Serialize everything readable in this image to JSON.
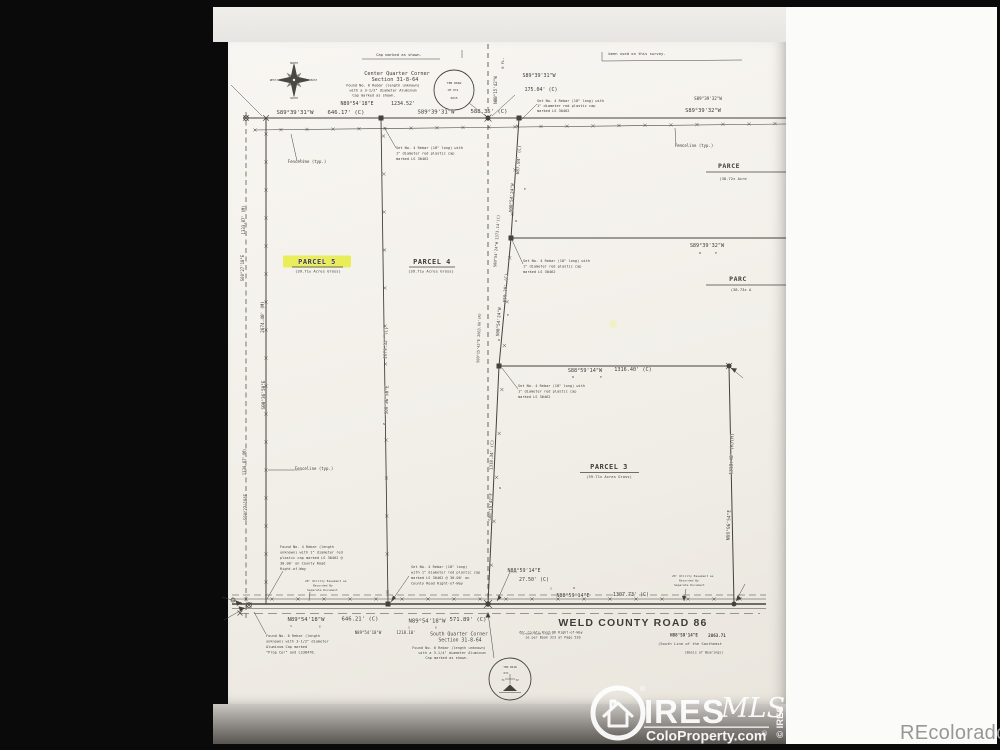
{
  "watermarks": {
    "recolorado": "REcolorado",
    "ires": {
      "name": "IRES",
      "mls": "MLS",
      "site": "ColoProperty.com",
      "reg": "®",
      "copyright": "© IRES"
    }
  },
  "plat": {
    "parcels": [
      {
        "name": "PARCEL 5",
        "area": "(39.71± Acres Gross)",
        "highlighted": true
      },
      {
        "name": "PARCEL 4",
        "area": "(39.71± Acres Gross)",
        "highlighted": false
      },
      {
        "name": "PARCEL 3",
        "area": "(39.71± Acres Gross)",
        "highlighted": false
      },
      {
        "name": "PARCE",
        "area": "(38.72± Acre",
        "highlighted": false
      },
      {
        "name": "PARC",
        "area": "(38.73± A",
        "highlighted": false
      }
    ],
    "road": {
      "name": "WELD COUNTY ROAD 86",
      "row_note": "60' County Road 86 Right-of-Way as per Book 323 at Page 520",
      "south_line": "(South Line of the Southeast",
      "basis": "(Basis of Bearings)"
    },
    "labels": [
      {
        "t": "Cap marked as shown.",
        "x": 399,
        "y": 56,
        "s": 3.8
      },
      {
        "t": "been used on this survey.",
        "x": 637,
        "y": 55,
        "s": 3.8
      },
      {
        "t": "Center Quarter Corner",
        "x": 397,
        "y": 75,
        "s": 5.2
      },
      {
        "t": "Section 31-8-64",
        "x": 395,
        "y": 81,
        "s": 5.2
      },
      {
        "t": "Found No. 6 Rebar (length unknown)",
        "x": 383,
        "y": 86.5,
        "s": 3.6
      },
      {
        "t": "with a 3-1/2\" diameter Aluminum",
        "x": 383,
        "y": 91.5,
        "s": 3.6
      },
      {
        "t": "Cap marked as shown.",
        "x": 374,
        "y": 96.5,
        "s": 3.6
      },
      {
        "t": "N89°54'18\"E",
        "x": 357,
        "y": 105,
        "s": 5
      },
      {
        "t": "1234.52'",
        "x": 403,
        "y": 105,
        "s": 5
      },
      {
        "t": "T8N R64W",
        "x": 454,
        "y": 84,
        "s": 3
      },
      {
        "t": "CM 931",
        "x": 453,
        "y": 91,
        "s": 3
      },
      {
        "t": "2015",
        "x": 454,
        "y": 99,
        "s": 3
      },
      {
        "t": "S89°39'31\"W",
        "x": 295,
        "y": 114,
        "s": 5.6
      },
      {
        "t": "646.17' (C)",
        "x": 346,
        "y": 114,
        "s": 5.6
      },
      {
        "t": "S89°39'31\"W",
        "x": 436,
        "y": 113.5,
        "s": 5.6
      },
      {
        "t": "588.35' (C)",
        "x": 489,
        "y": 113,
        "s": 5.6
      },
      {
        "t": "S89°39'31\"W",
        "x": 539,
        "y": 77,
        "s": 5
      },
      {
        "t": "175.04' (C)",
        "x": 541,
        "y": 91,
        "s": 5
      },
      {
        "t": "S89°39'32\"W",
        "x": 708,
        "y": 100,
        "s": 4.2
      },
      {
        "t": "S89°39'32\"W",
        "x": 703,
        "y": 112,
        "s": 5.4
      },
      {
        "t": "6 FL.",
        "x": 504,
        "y": 63,
        "s": 3.8,
        "r": -90
      },
      {
        "t": "N00°15'42\"W",
        "x": 497,
        "y": 90,
        "s": 4.2,
        "r": -90
      },
      {
        "t": "Set No. 4 Rebar (18\" long) with",
        "x": 396,
        "y": 149,
        "s": 3.6,
        "a": "s"
      },
      {
        "t": "1\" diameter red plastic cap",
        "x": 396,
        "y": 154.5,
        "s": 3.6,
        "a": "s"
      },
      {
        "t": "marked LS 30462",
        "x": 396,
        "y": 160,
        "s": 3.6,
        "a": "s"
      },
      {
        "t": "Set No. 4 Rebar (18\" long) with",
        "x": 537,
        "y": 102,
        "s": 3.6,
        "a": "s"
      },
      {
        "t": "1\" diameter red plastic cap",
        "x": 537,
        "y": 107,
        "s": 3.6,
        "a": "s"
      },
      {
        "t": "marked LS 30462",
        "x": 537,
        "y": 112,
        "s": 3.6,
        "a": "s"
      },
      {
        "t": "Set No. 4 Rebar (18\" long) with",
        "x": 523,
        "y": 262,
        "s": 3.6,
        "a": "s"
      },
      {
        "t": "1\" diameter red plastic cap",
        "x": 523,
        "y": 267.5,
        "s": 3.6,
        "a": "s"
      },
      {
        "t": "marked LS 30462",
        "x": 523,
        "y": 273,
        "s": 3.6,
        "a": "s"
      },
      {
        "t": "Set No. 4 Rebar (18\" long) with",
        "x": 518,
        "y": 387,
        "s": 3.6,
        "a": "s"
      },
      {
        "t": "1\" diameter red plastic cap",
        "x": 518,
        "y": 392.5,
        "s": 3.6,
        "a": "s"
      },
      {
        "t": "marked LS 30462",
        "x": 518,
        "y": 398,
        "s": 3.6,
        "a": "s"
      },
      {
        "t": "Fenceline (typ.)",
        "x": 307,
        "y": 163,
        "s": 4
      },
      {
        "t": "Fenceline (typ.)",
        "x": 694,
        "y": 147,
        "s": 4
      },
      {
        "t": "Fenceline (typ.)",
        "x": 314,
        "y": 470,
        "s": 4
      },
      {
        "t": "687.84' (C)",
        "x": 520,
        "y": 160,
        "s": 4.4,
        "r": -86
      },
      {
        "t": "S00°54'24\"W",
        "x": 513,
        "y": 198,
        "s": 4.4,
        "r": -86
      },
      {
        "t": "E",
        "x": 525,
        "y": 190,
        "s": 3
      },
      {
        "t": "N",
        "x": 516,
        "y": 222,
        "s": 3
      },
      {
        "t": "S00°54'24\"W 1373.14'(C)",
        "x": 498,
        "y": 241,
        "s": 3.8,
        "r": -86
      },
      {
        "t": "650.30' (C)",
        "x": 507,
        "y": 288,
        "s": 4.4,
        "r": -86
      },
      {
        "t": "S00°54'24\"W",
        "x": 500,
        "y": 322,
        "s": 4.4,
        "r": -86
      },
      {
        "t": "E",
        "x": 508,
        "y": 316,
        "s": 3
      },
      {
        "t": "N",
        "x": 499,
        "y": 341,
        "s": 3
      },
      {
        "t": "S00°15'42\"E 2663.66'(R)",
        "x": 480,
        "y": 338,
        "s": 3.6,
        "r": -88
      },
      {
        "t": "1333.87' (M)",
        "x": 245,
        "y": 220,
        "s": 4,
        "r": -90
      },
      {
        "t": "S00°27'18\"E",
        "x": 244,
        "y": 268,
        "s": 4,
        "r": -90
      },
      {
        "t": "2674.40' (M)",
        "x": 264,
        "y": 317,
        "s": 4.4,
        "r": -90
      },
      {
        "t": "S00°36'50\"E",
        "x": 265,
        "y": 395,
        "s": 4.4,
        "r": -90
      },
      {
        "t": "1330.87'(M)",
        "x": 246,
        "y": 462,
        "s": 4,
        "r": -90
      },
      {
        "t": "S00°27'18\"E",
        "x": 247,
        "y": 507,
        "s": 4,
        "r": -90
      },
      {
        "t": "2679.32' (C)",
        "x": 387,
        "y": 343,
        "s": 4.4,
        "r": -88
      },
      {
        "t": "S00°36'50\"E",
        "x": 388,
        "y": 400,
        "s": 4.4,
        "r": -88
      },
      {
        "t": "N",
        "x": 384,
        "y": 425,
        "s": 3
      },
      {
        "t": "PARCEL 5",
        "x": 317,
        "y": 264,
        "s": 7,
        "b": 1,
        "ls": 0.5
      },
      {
        "t": "(39.71± Acres Gross)",
        "x": 318,
        "y": 272.5,
        "s": 3.8
      },
      {
        "t": "PARCEL 4",
        "x": 432,
        "y": 264,
        "s": 7,
        "b": 1,
        "ls": 0.5
      },
      {
        "t": "(39.71± Acres Gross)",
        "x": 431,
        "y": 272.5,
        "s": 3.8
      },
      {
        "t": "PARCEL 3",
        "x": 609,
        "y": 469,
        "s": 7,
        "b": 1,
        "ls": 0.5
      },
      {
        "t": "(39.71± Acres Gross)",
        "x": 609,
        "y": 478,
        "s": 3.8
      },
      {
        "t": "PARCE",
        "x": 729,
        "y": 168,
        "s": 6.5,
        "b": 1,
        "ls": 0.5
      },
      {
        "t": "(38.72± Acre",
        "x": 733,
        "y": 180,
        "s": 3.8
      },
      {
        "t": "PARC",
        "x": 738,
        "y": 281,
        "s": 6.5,
        "b": 1,
        "ls": 0.5
      },
      {
        "t": "(38.73± A",
        "x": 741,
        "y": 291,
        "s": 3.8
      },
      {
        "t": "S89°39'32\"W",
        "x": 707,
        "y": 247,
        "s": 5.2
      },
      {
        "t": "N",
        "x": 700,
        "y": 254,
        "s": 3
      },
      {
        "t": "E",
        "x": 716,
        "y": 254,
        "s": 3
      },
      {
        "t": "S88°59'14\"W",
        "x": 585,
        "y": 372,
        "s": 5.2
      },
      {
        "t": "1316.40' (C)",
        "x": 633,
        "y": 371,
        "s": 5.2
      },
      {
        "t": "N",
        "x": 573,
        "y": 378,
        "s": 3
      },
      {
        "t": "E",
        "x": 601,
        "y": 378,
        "s": 3
      },
      {
        "t": "1318.48' (R)(M)",
        "x": 733,
        "y": 454,
        "s": 4.6,
        "r": -88
      },
      {
        "t": "N00°06'54\"E",
        "x": 730,
        "y": 525,
        "s": 4.6,
        "r": -88
      },
      {
        "t": "1318.34' (C)",
        "x": 493,
        "y": 455,
        "s": 4.2,
        "r": -88
      },
      {
        "t": "N",
        "x": 500,
        "y": 489,
        "s": 3
      },
      {
        "t": "S00°15'42\"E",
        "x": 492,
        "y": 507,
        "s": 4.2,
        "r": -88
      },
      {
        "t": "Found No. 4 Rebar (length",
        "x": 280,
        "y": 548,
        "s": 3.6,
        "a": "s"
      },
      {
        "t": "unknown) with 1\" diameter red",
        "x": 280,
        "y": 553.5,
        "s": 3.6,
        "a": "s"
      },
      {
        "t": "plastic cap marked LS 30462 @",
        "x": 280,
        "y": 559,
        "s": 3.6,
        "a": "s"
      },
      {
        "t": "30.00' on County Road",
        "x": 280,
        "y": 564.5,
        "s": 3.6,
        "a": "s"
      },
      {
        "t": "Right-of-Way",
        "x": 280,
        "y": 570,
        "s": 3.6,
        "a": "s"
      },
      {
        "t": "20' Utility Easement as",
        "x": 305,
        "y": 582,
        "s": 3,
        "a": "s"
      },
      {
        "t": "Recorded By",
        "x": 313,
        "y": 586.5,
        "s": 3,
        "a": "s"
      },
      {
        "t": "Separate Document",
        "x": 307,
        "y": 591,
        "s": 3,
        "a": "s"
      },
      {
        "t": "Set No. 4 Rebar (18\" long)",
        "x": 411,
        "y": 568,
        "s": 3.6,
        "a": "s"
      },
      {
        "t": "with 1\" diameter red plastic cap",
        "x": 411,
        "y": 573.5,
        "s": 3.6,
        "a": "s"
      },
      {
        "t": "marked LS 30462 @ 30.00' on",
        "x": 411,
        "y": 579,
        "s": 3.6,
        "a": "s"
      },
      {
        "t": "County Road Right-of-Way",
        "x": 411,
        "y": 584.5,
        "s": 3.6,
        "a": "s"
      },
      {
        "t": "N88°59'14\"E",
        "x": 524,
        "y": 572,
        "s": 5
      },
      {
        "t": "27.50' (C)",
        "x": 534,
        "y": 581,
        "s": 5
      },
      {
        "t": "20' Utility Easement as",
        "x": 672,
        "y": 577,
        "s": 3,
        "a": "s"
      },
      {
        "t": "Recorded By",
        "x": 679,
        "y": 581.5,
        "s": 3,
        "a": "s"
      },
      {
        "t": "Separate Document",
        "x": 674,
        "y": 586,
        "s": 3,
        "a": "s"
      },
      {
        "t": "S",
        "x": 551,
        "y": 589.5,
        "s": 3
      },
      {
        "t": "W",
        "x": 574,
        "y": 589,
        "s": 3
      },
      {
        "t": "N88°59'14\"E",
        "x": 573,
        "y": 597,
        "s": 5
      },
      {
        "t": "1307.73' (C)",
        "x": 631,
        "y": 596,
        "s": 5
      },
      {
        "t": "N89°54'18\"W",
        "x": 306,
        "y": 621,
        "s": 5.6
      },
      {
        "t": "646.21' (C)",
        "x": 360,
        "y": 620.5,
        "s": 5.6
      },
      {
        "t": "S",
        "x": 291,
        "y": 627,
        "s": 3
      },
      {
        "t": "E",
        "x": 320,
        "y": 627.5,
        "s": 3
      },
      {
        "t": "N89°54'18\"W",
        "x": 427,
        "y": 622.5,
        "s": 5.6
      },
      {
        "t": "571.89' (C)",
        "x": 468,
        "y": 621,
        "s": 5.6
      },
      {
        "t": "S",
        "x": 409,
        "y": 628.5,
        "s": 3
      },
      {
        "t": "E",
        "x": 436,
        "y": 628.5,
        "s": 3
      },
      {
        "t": "N89°54'18\"W",
        "x": 368,
        "y": 634,
        "s": 4
      },
      {
        "t": "1218.10'",
        "x": 406,
        "y": 634,
        "s": 4
      },
      {
        "t": "WELD COUNTY ROAD 86",
        "x": 633,
        "y": 626,
        "s": 10.5,
        "b": 1,
        "f": "sans",
        "ls": 1.2
      },
      {
        "t": "60' County Road 86 Right-of-Way",
        "x": 551,
        "y": 633.5,
        "s": 3.4
      },
      {
        "t": "as per Book 323 at Page 520",
        "x": 553,
        "y": 638.5,
        "s": 3.4
      },
      {
        "t": "N88°59'14\"E",
        "x": 684,
        "y": 636.5,
        "s": 4.2,
        "b": 1
      },
      {
        "t": "2863.71",
        "x": 717,
        "y": 637,
        "s": 4.2,
        "b": 1
      },
      {
        "t": "(South Line of the Southeast",
        "x": 690,
        "y": 645,
        "s": 3.8
      },
      {
        "t": "(Basis of Bearings)",
        "x": 704,
        "y": 653.5,
        "s": 3.4
      },
      {
        "t": "(Gravel Road (Typ))",
        "x": 537,
        "y": 634.5,
        "s": 2.8
      },
      {
        "t": "South Quarter Corner",
        "x": 459,
        "y": 635.5,
        "s": 4.8
      },
      {
        "t": "Section 31-8-64",
        "x": 460,
        "y": 641.5,
        "s": 4.8
      },
      {
        "t": "Found No. 6 Rebar (length unknown)",
        "x": 449,
        "y": 649,
        "s": 3.6
      },
      {
        "t": "with a 3-1/4\" diameter Aluminum",
        "x": 452,
        "y": 654,
        "s": 3.6
      },
      {
        "t": "Cap marked as shown.",
        "x": 447,
        "y": 659,
        "s": 3.6
      },
      {
        "t": "Found No. 6 Rebar (length",
        "x": 266,
        "y": 637,
        "s": 3.6,
        "a": "s"
      },
      {
        "t": "unknown) with 3-1/2\" diameter",
        "x": 266,
        "y": 642.5,
        "s": 3.6,
        "a": "s"
      },
      {
        "t": "Aluminum Cap marked",
        "x": 266,
        "y": 648,
        "s": 3.6,
        "a": "s"
      },
      {
        "t": "\"Prop Cor\" and LS38478.",
        "x": 266,
        "y": 653.5,
        "s": 3.6,
        "a": "s"
      },
      {
        "t": "T8N R64W",
        "x": 510,
        "y": 668,
        "s": 2.8
      },
      {
        "t": "631",
        "x": 506,
        "y": 674,
        "s": 2.8
      },
      {
        "t": "31",
        "x": 503,
        "y": 681,
        "s": 2.8
      },
      {
        "t": "32",
        "x": 517,
        "y": 681,
        "s": 2.8
      },
      {
        "t": "NORTH",
        "x": 294,
        "y": 64,
        "s": 2.6
      },
      {
        "t": "SOUTH",
        "x": 294,
        "y": 99,
        "s": 2.6
      },
      {
        "t": "WEST",
        "x": 273,
        "y": 81,
        "s": 2.6
      },
      {
        "t": "EAST",
        "x": 314,
        "y": 81,
        "s": 2.6
      }
    ]
  }
}
